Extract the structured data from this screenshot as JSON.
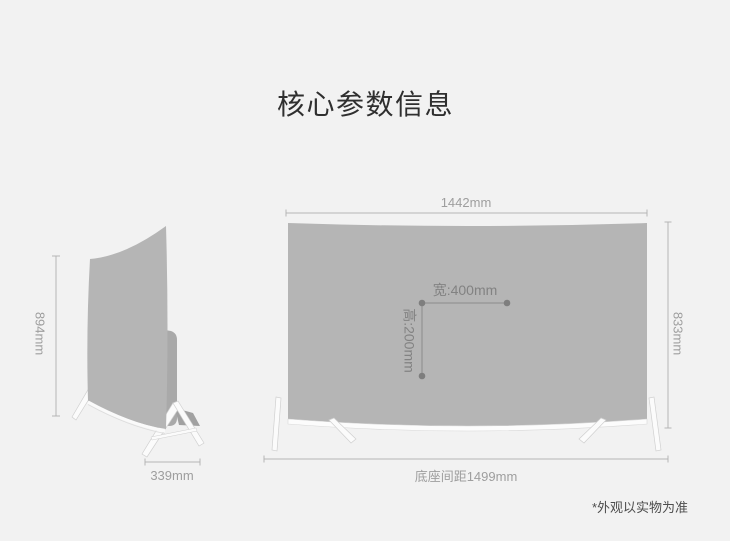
{
  "title": "核心参数信息",
  "side_view": {
    "height": "894mm",
    "depth": "339mm"
  },
  "front_view": {
    "width": "1442mm",
    "height": "833mm",
    "base_distance": "底座间距1499mm",
    "vesa_width": "宽:400mm",
    "vesa_height": "高:200mm"
  },
  "footnote": "*外观以实物为准",
  "colors": {
    "page_background": "#f2f2f2",
    "screen_gray": "#b5b5b5",
    "side_back_panel": "#a9a9a9",
    "stand_white": "#fbfbfb",
    "dimension_line": "#b5b5b5",
    "dimension_text": "#9e9e9e",
    "vesa_marker": "#7e7e7e",
    "title_text": "#2f2f2f",
    "footnote_text": "#4d4d4d"
  }
}
